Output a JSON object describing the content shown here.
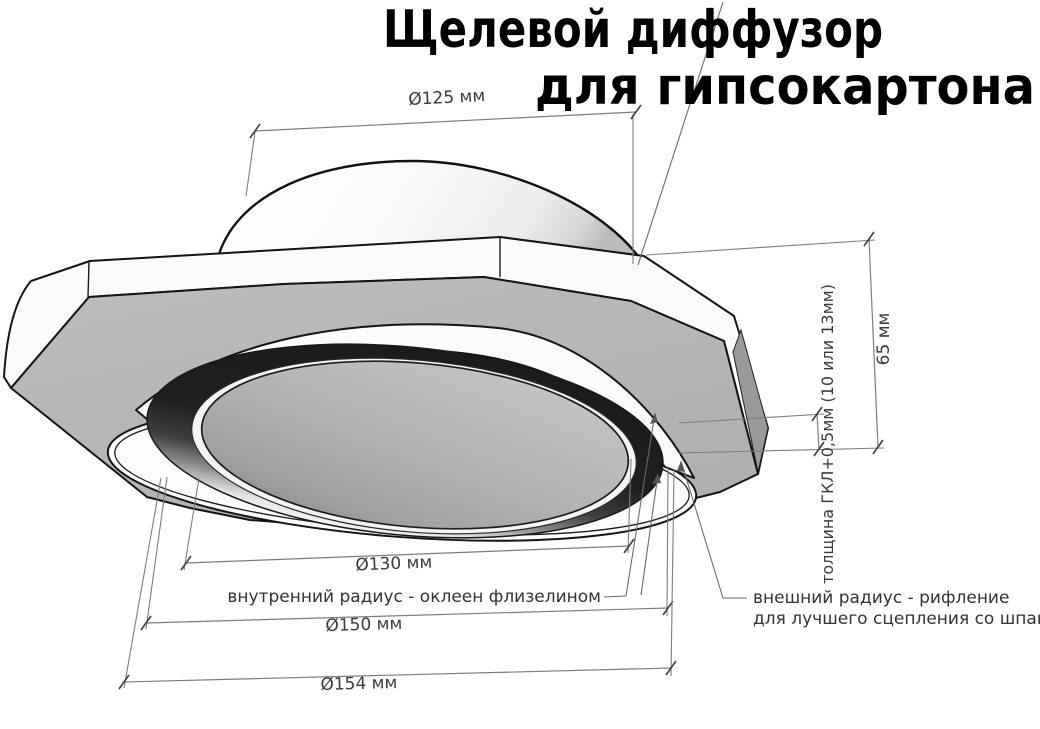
{
  "title": {
    "line1": "Щелевой диффузор",
    "line2": "для гипсокартона"
  },
  "dimensions": {
    "top_diameter": "Ø125 мм",
    "inner_diameter": "Ø130 мм",
    "mid_diameter": "Ø150 мм",
    "outer_diameter": "Ø154 мм",
    "height": "65 мм",
    "board_thickness": "толщина ГКЛ+0,5мм (10 или 13мм)"
  },
  "annotations": {
    "inner_radius": "внутренний радиус - оклеен флизелином",
    "outer_radius_line1": "внешний радиус - рифление",
    "outer_radius_line2": "для лучшего сцепления со шпаклёвкой"
  },
  "colors": {
    "background": "#ffffff",
    "plate_gray": "#b7b7b7",
    "face_white": "#fbfbfb",
    "slot_dark": "#1b1b1b",
    "disc_gray": "#b2b2b2",
    "bevel_gray": "#9a9a9a",
    "collar_gray": "#8f8f8f",
    "outline": "#141414",
    "dim_line": "#7d7d7d",
    "dim_text": "#3c3c3c",
    "title_color": "#000000"
  }
}
